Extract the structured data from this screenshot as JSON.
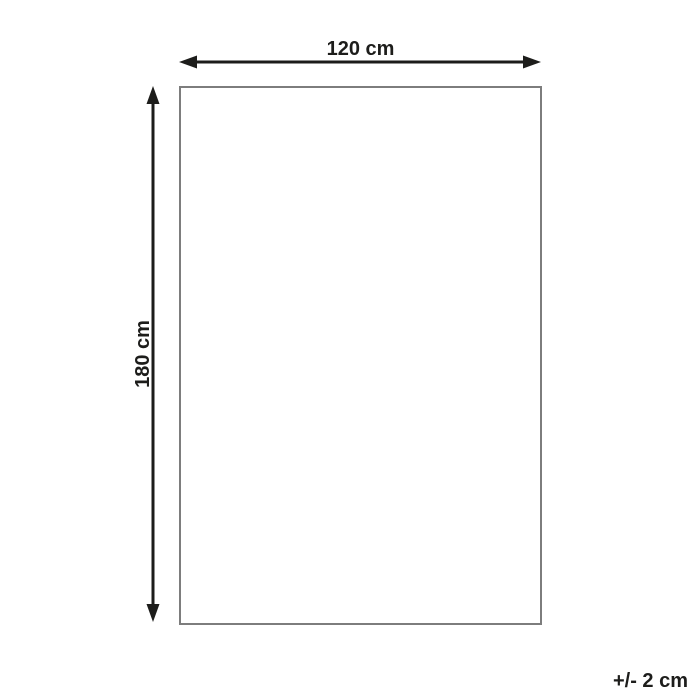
{
  "diagram": {
    "width_label": "120 cm",
    "height_label": "180 cm",
    "tolerance_label": "+/- 2 cm",
    "colors": {
      "arrow": "#1d1d1b",
      "rect_border": "#7d7d7d",
      "background": "#ffffff"
    }
  }
}
